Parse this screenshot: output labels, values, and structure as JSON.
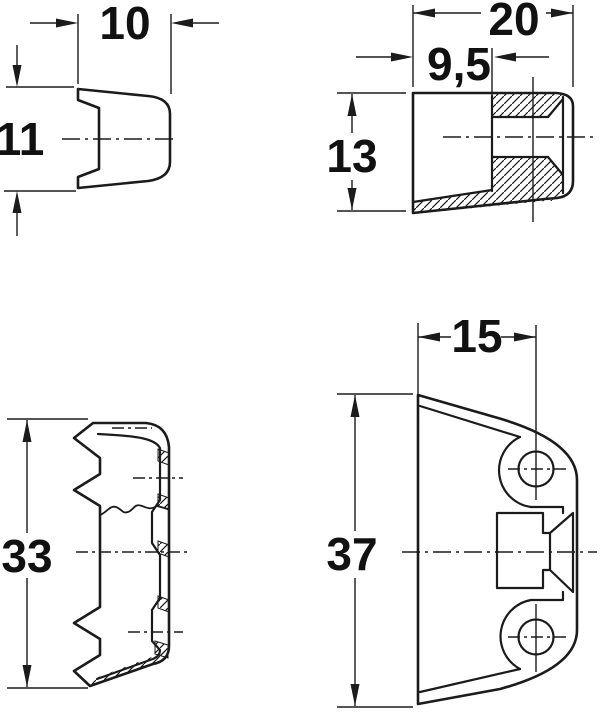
{
  "drawing": {
    "background": "#ffffff",
    "line_color": "#1b1b1b",
    "text_color": "#111111"
  },
  "dims": {
    "d10": "10",
    "d11": "11",
    "d20": "20",
    "d95": "9,5",
    "d13": "13",
    "d15": "15",
    "d33": "33",
    "d37": "37"
  }
}
